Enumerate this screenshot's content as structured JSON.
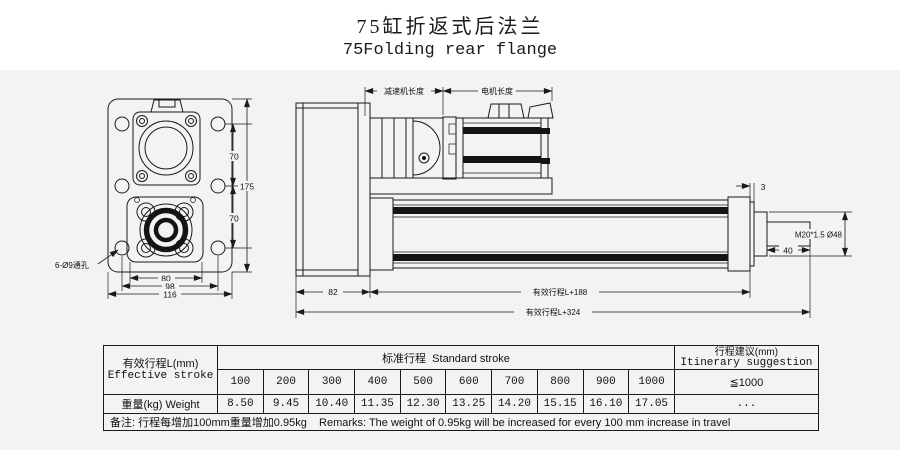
{
  "title": {
    "zh": "75缸折返式后法兰",
    "en": "75Folding rear flange"
  },
  "front_view": {
    "dim_70_top": "70",
    "dim_70_bottom": "70",
    "dim_175": "175",
    "dim_80": "80",
    "dim_98": "98",
    "dim_116": "116",
    "holes_label": "6-Ø9通孔"
  },
  "side_view": {
    "dim_gearbox_length": "减速机长度",
    "dim_motor_length": "电机长度",
    "dim_front_plate": "3",
    "dim_rod_length": "40",
    "rod_thread_label": "M20*1.5 Ø48",
    "dim_rear_length": "82",
    "dim_stroke_188": "有效行程L+188",
    "dim_stroke_324": "有效行程L+324"
  },
  "table": {
    "effective_stroke_zh": "有效行程L(mm)",
    "effective_stroke_en": "Effective stroke",
    "standard_stroke_header": "标准行程  Standard stroke",
    "suggestion_zh": "行程建议(mm)",
    "suggestion_en": "Itinerary suggestion",
    "suggestion_value": "≦1000",
    "strokes": [
      "100",
      "200",
      "300",
      "400",
      "500",
      "600",
      "700",
      "800",
      "900",
      "1000"
    ],
    "weight_label": "重量(kg) Weight",
    "weights": [
      "8.50",
      "9.45",
      "10.40",
      "11.35",
      "12.30",
      "13.25",
      "14.20",
      "15.15",
      "16.10",
      "17.05"
    ],
    "weights_extra": "...",
    "remarks": "备注: 行程每增加100mm重量增加0.95kg    Remarks: The weight of 0.95kg will be increased for every 100 mm increase in travel"
  },
  "colors": {
    "line": "#1a1a1a",
    "background": "#f3f3f4",
    "stripe": "#141414",
    "title_strip": "#ffffff"
  }
}
